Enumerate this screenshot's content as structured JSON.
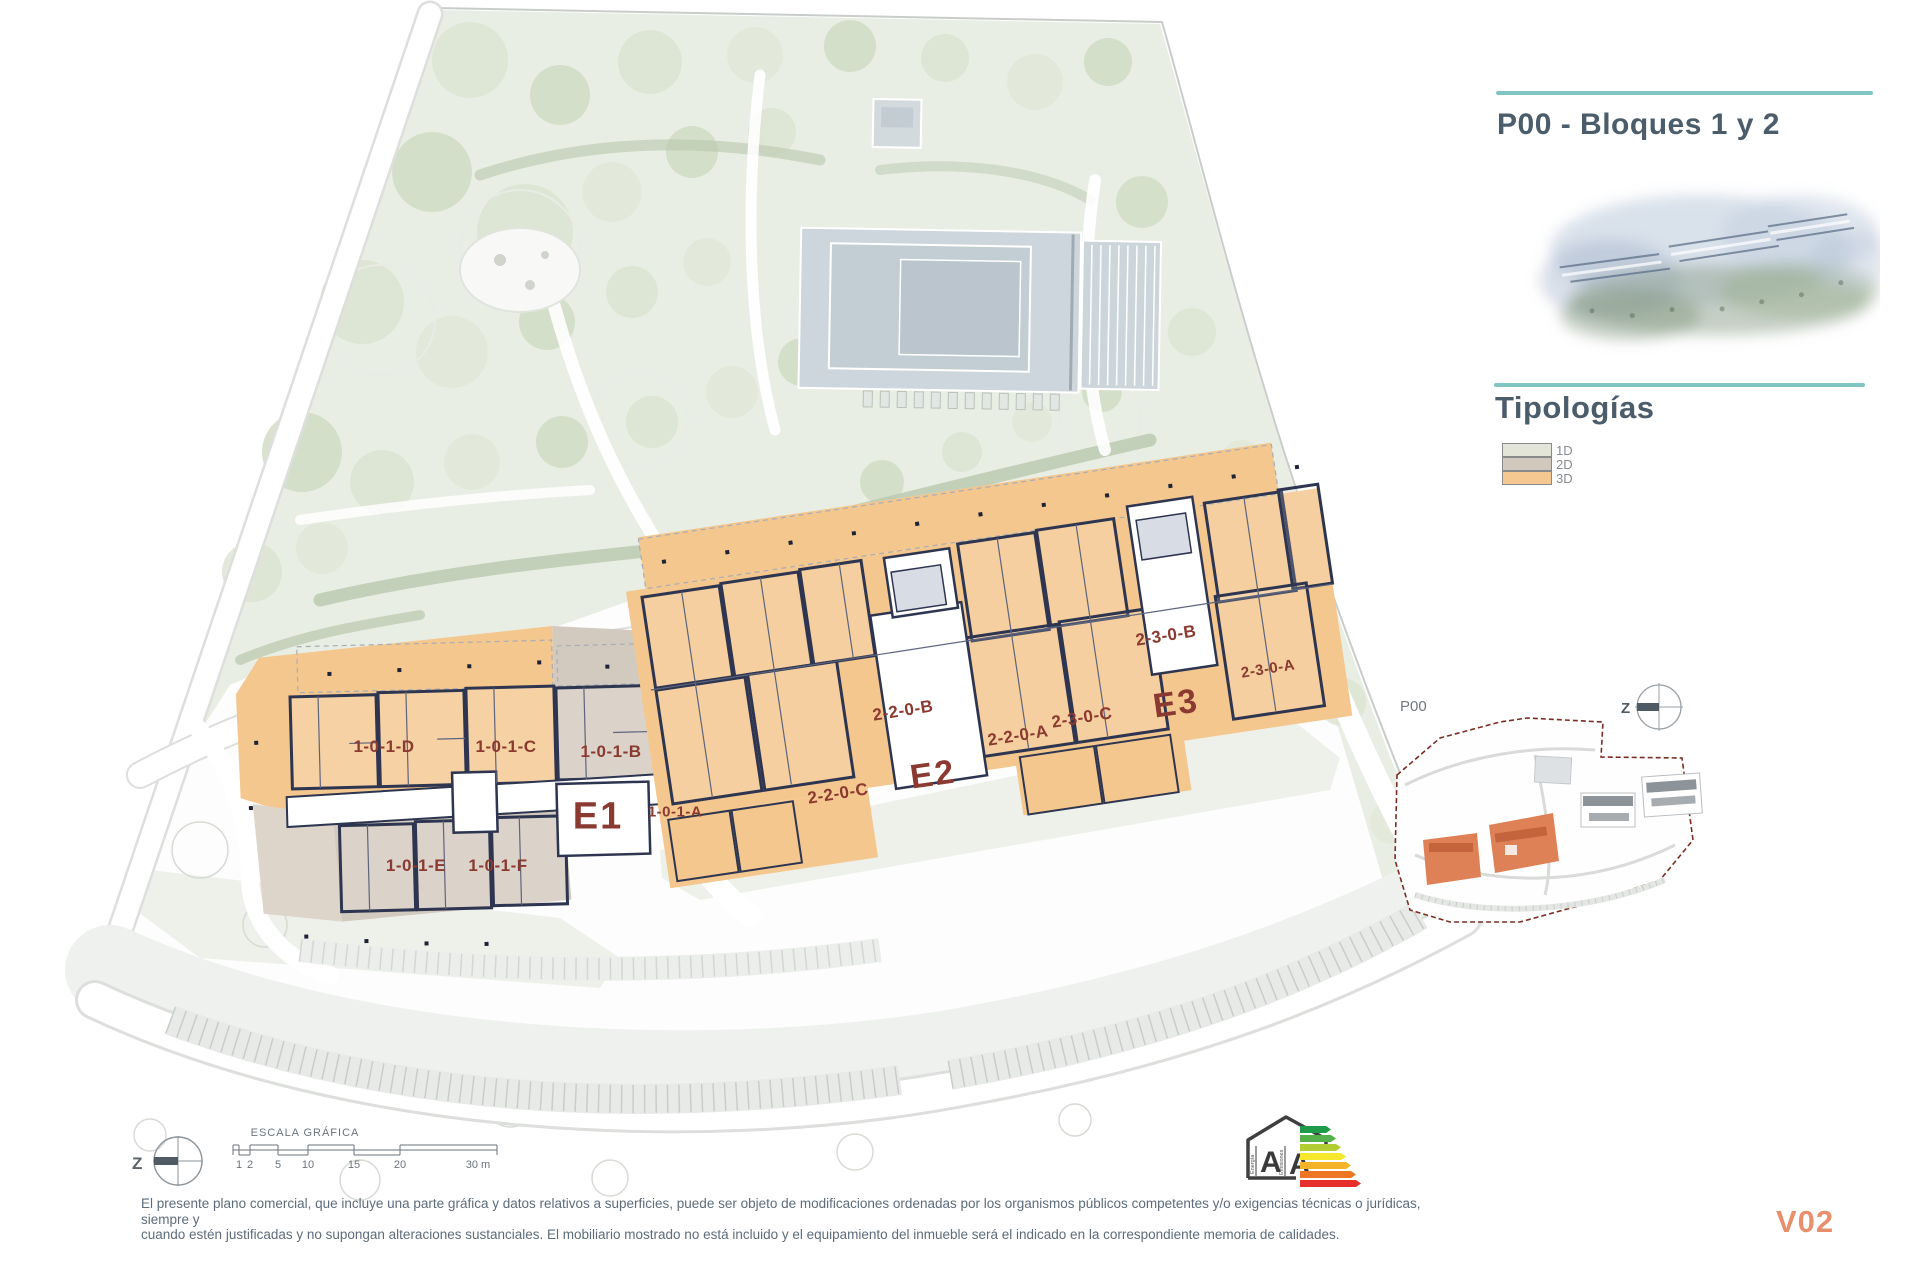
{
  "page": {
    "version_label": "V02",
    "disclaimer_line1": "El presente plano comercial, que incluye una parte gráfica y datos relativos a superficies, puede ser objeto de modificaciones ordenadas por los organismos públicos competentes y/o exigencias técnicas o jurídicas, siempre y",
    "disclaimer_line2": "cuando estén justificadas y no supongan alteraciones sustanciales. El mobiliario mostrado no está incluido y el equipamiento del inmueble será el indicado en la correspondiente memoria de calidades."
  },
  "sidebar": {
    "title": "P00 - Bloques 1 y 2",
    "section_title": "Tipologías",
    "accent_color": "#7fc6c2",
    "legend": [
      {
        "label": "1D",
        "color": "#e4e5d9"
      },
      {
        "label": "2D",
        "color": "#d2c9be"
      },
      {
        "label": "3D",
        "color": "#f5c891"
      }
    ]
  },
  "plan": {
    "label_color": "#8a3a30",
    "blocks": [
      {
        "text": "E1"
      },
      {
        "text": "E2"
      },
      {
        "text": "E3"
      }
    ],
    "units": [
      {
        "text": "1-0-1-D"
      },
      {
        "text": "1-0-1-C"
      },
      {
        "text": "1-0-1-B"
      },
      {
        "text": "1-0-1-A"
      },
      {
        "text": "1-0-1-E"
      },
      {
        "text": "1-0-1-F"
      },
      {
        "text": "2-2-0-B"
      },
      {
        "text": "2-2-0-A"
      },
      {
        "text": "2-2-0-C"
      },
      {
        "text": "2-3-0-C"
      },
      {
        "text": "2-3-0-B"
      },
      {
        "text": "2-3-0-A"
      }
    ]
  },
  "minimap": {
    "label": "P00"
  },
  "compass": {
    "letter": "Z"
  },
  "scalebar": {
    "title": "ESCALA GRÁFICA",
    "ticks": [
      "1",
      "2",
      "5",
      "10",
      "15",
      "20",
      "30 m"
    ]
  },
  "energy": {
    "letters": [
      "A",
      "A"
    ],
    "axis_left": "Energía",
    "axis_right": "Emisiones",
    "colors": [
      "#1f9c49",
      "#54b04a",
      "#b2cc34",
      "#f4e72c",
      "#f5b32a",
      "#ee7524",
      "#e62e2a"
    ]
  }
}
